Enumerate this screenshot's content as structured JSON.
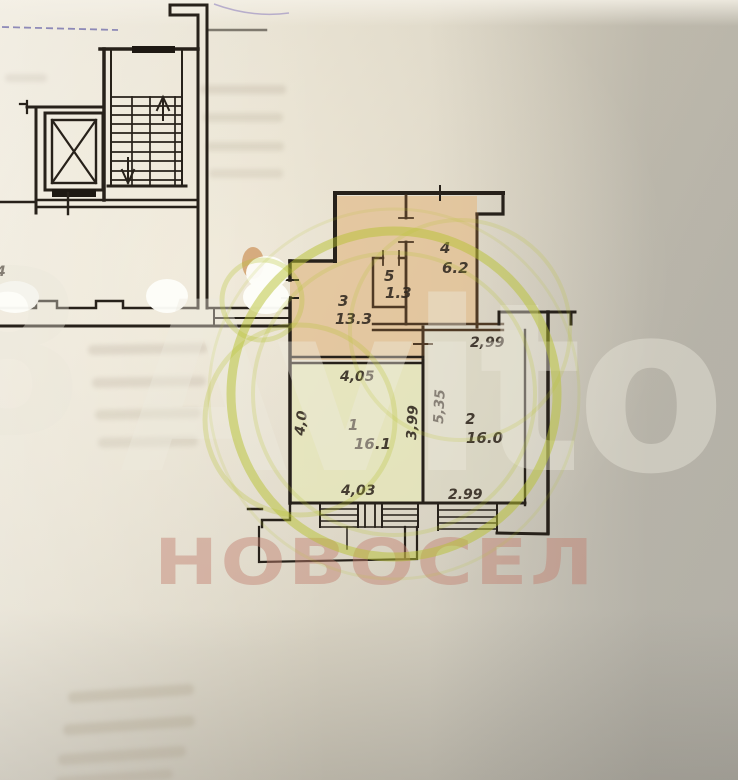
{
  "plan": {
    "rooms": [
      {
        "id": "1",
        "area": "16.1"
      },
      {
        "id": "2",
        "area": "16.0"
      },
      {
        "id": "3",
        "area": "13.3"
      },
      {
        "id": "4",
        "area": "6.2"
      },
      {
        "id": "5",
        "area": "1.3"
      }
    ],
    "dimensions": {
      "bay_top": "2,99",
      "hall_bottom": "4,05",
      "room1_left": "4,0",
      "room1_right": "3,99",
      "room2_left": "5,35",
      "room1_bottom": "4,03",
      "room2_bottom": "2.99"
    },
    "margin_note": "4"
  },
  "watermarks": {
    "portal_text": "Avito",
    "portal_glyph": "8",
    "agency_text": "НОВОСЕЛ"
  },
  "colors": {
    "watermark_green": "#b7c232",
    "agency_rose": "#c07f70",
    "paper_warm": "#e6e0d1",
    "paper_gray": "#c9c6bd",
    "room_warm_tint": "#e2c094",
    "room_cool_tint": "#e6e7b8",
    "wall_ink": "#27211a"
  }
}
